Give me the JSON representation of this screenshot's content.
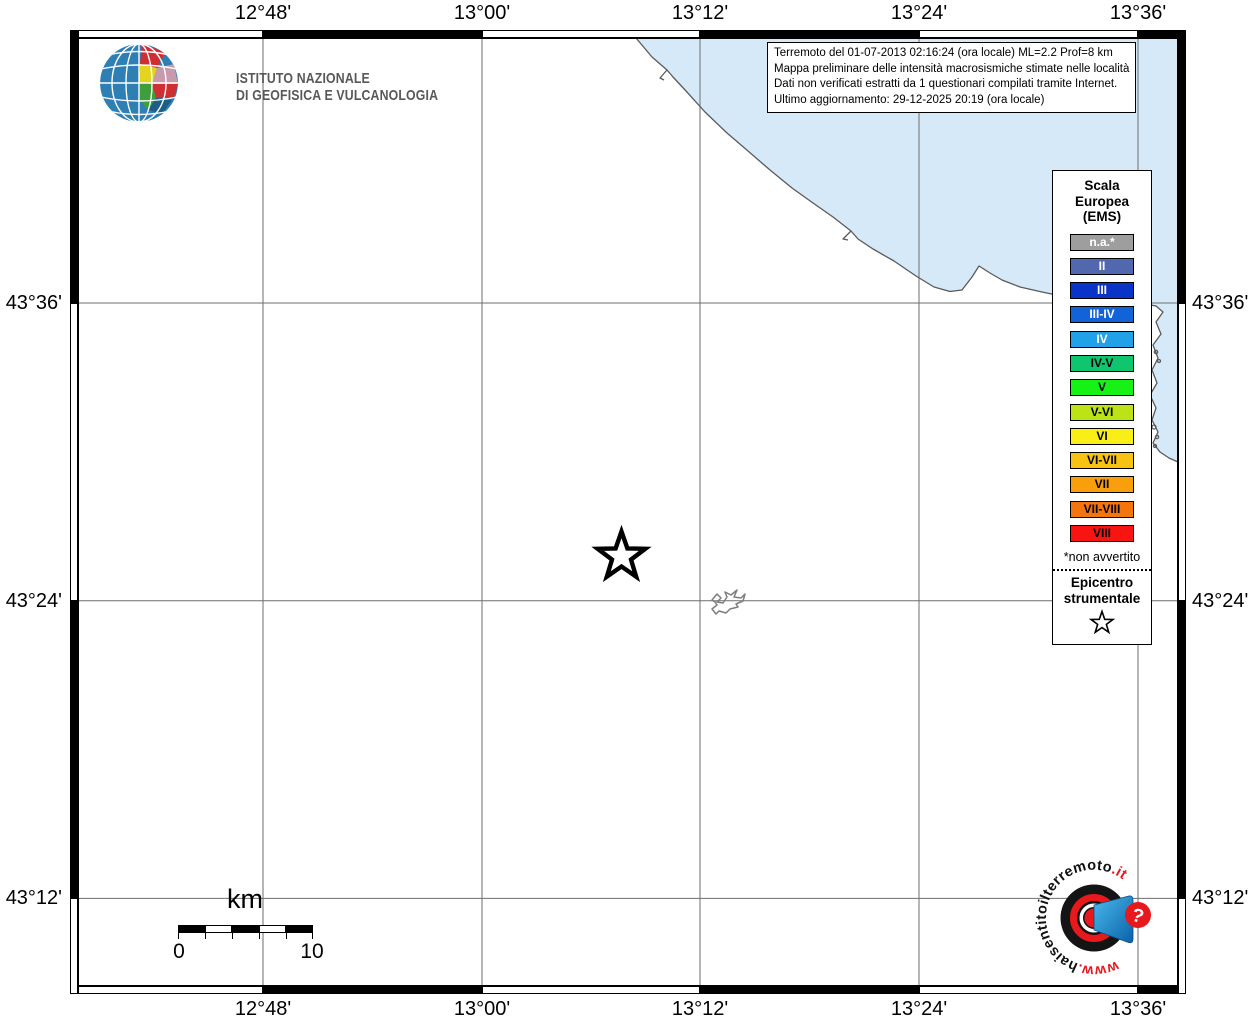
{
  "axes": {
    "top": [
      "12°48'",
      "13°00'",
      "13°12'",
      "13°24'",
      "13°36'"
    ],
    "bottom": [
      "12°48'",
      "13°00'",
      "13°12'",
      "13°24'",
      "13°36'"
    ],
    "left": [
      "43°36'",
      "43°24'",
      "43°12'"
    ],
    "right": [
      "43°36'",
      "43°24'",
      "43°12'"
    ]
  },
  "branding": {
    "ingv_line1": "ISTITUTO NAZIONALE",
    "ingv_line2": "DI GEOFISICA E VULCANOLOGIA"
  },
  "info_box": {
    "lines": [
      "Terremoto del 01-07-2013 02:16:24 (ora locale) ML=2.2 Prof=8 km",
      "Mappa preliminare delle intensità macrosismiche stimate nelle località",
      "Dati non verificati estratti da 1 questionari compilati tramite Internet.",
      "Ultimo aggiornamento: 29-12-2025 20:19 (ora locale)"
    ]
  },
  "legend": {
    "title_lines": [
      "Scala",
      "Europea",
      "(EMS)"
    ],
    "items": [
      {
        "label": "n.a.*",
        "color": "#9e9e9e",
        "text_color": "#ffffff"
      },
      {
        "label": "II",
        "color": "#5268ae",
        "text_color": "#ffffff"
      },
      {
        "label": "III",
        "color": "#0a34c8",
        "text_color": "#ffffff"
      },
      {
        "label": "III-IV",
        "color": "#1263d8",
        "text_color": "#ffffff"
      },
      {
        "label": "IV",
        "color": "#21a1e8",
        "text_color": "#ffffff"
      },
      {
        "label": "IV-V",
        "color": "#0fc56d",
        "text_color": "#000000"
      },
      {
        "label": "V",
        "color": "#16f216",
        "text_color": "#000000"
      },
      {
        "label": "V-VI",
        "color": "#bbe315",
        "text_color": "#000000"
      },
      {
        "label": "VI",
        "color": "#f9ef16",
        "text_color": "#000000"
      },
      {
        "label": "VI-VII",
        "color": "#f8c213",
        "text_color": "#000000"
      },
      {
        "label": "VII",
        "color": "#f99f0b",
        "text_color": "#000000"
      },
      {
        "label": "VII-VIII",
        "color": "#f4740e",
        "text_color": "#000000"
      },
      {
        "label": "VIII",
        "color": "#f81511",
        "text_color": "#000000"
      }
    ],
    "footnote": "*non avvertito",
    "epicenter_lines": [
      "Epicentro",
      "strumentale"
    ]
  },
  "scale_bar": {
    "unit": "km",
    "start_label": "0",
    "end_label": "10"
  },
  "watermark": {
    "prefix": "www.",
    "middle": "haisentitoilterremoto",
    "suffix": ".it",
    "question_mark": "?"
  },
  "map": {
    "sea_color": "#d6e9f8",
    "grid_color": "#6e6e6e",
    "coast_color": "#5a5a5a"
  }
}
